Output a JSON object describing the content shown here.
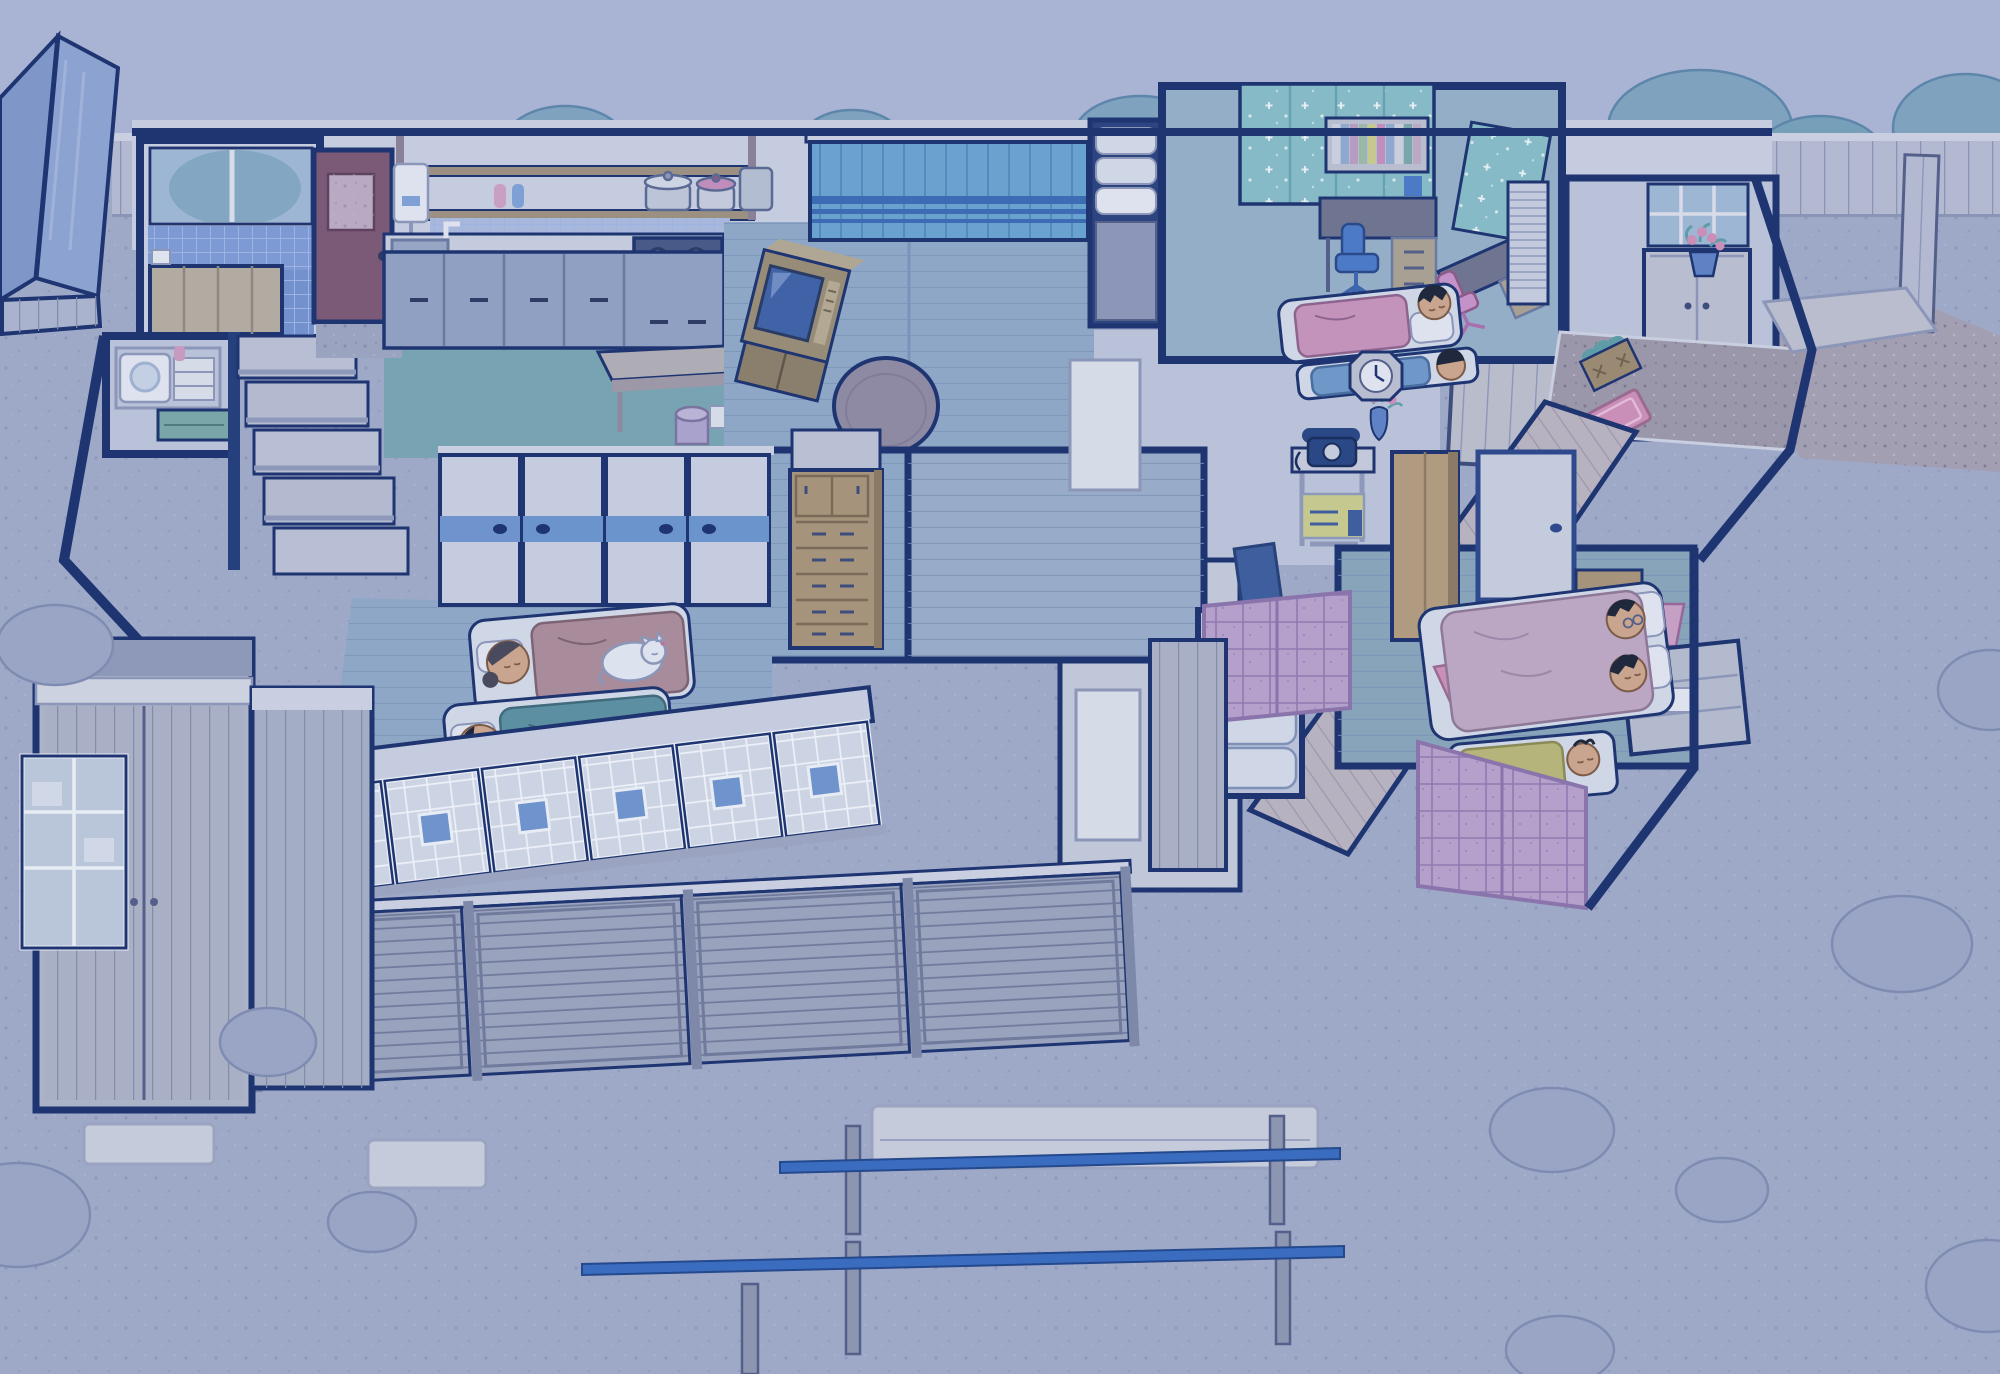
{
  "scene": {
    "title": "japanese-house-night-cutaway",
    "time_of_day": "night",
    "style": "isometric anime cutaway of a traditional Japanese family home, roof removed, blue night tint",
    "outdoor": [
      "wood plank fence",
      "blue-roof shed",
      "garden bushes",
      "gravel yard",
      "stone slabs",
      "two laundry drying poles",
      "stone path",
      "side fence"
    ],
    "rooms": [
      {
        "name": "bathroom",
        "objects": [
          "window with bush view",
          "blue tiled wall",
          "tiled floor",
          "covered wooden bathtub",
          "faucet"
        ]
      },
      {
        "name": "laundry-room",
        "objects": [
          "washing machine",
          "towel shelf",
          "bottle",
          "green cabinet"
        ]
      },
      {
        "name": "staircase",
        "objects": [
          "five descending steps"
        ]
      },
      {
        "name": "kitchen",
        "objects": [
          "maroon back door",
          "door mat",
          "wall shelf with pots",
          "spray bottles",
          "tankless water heater",
          "tile backsplash",
          "sink with faucet",
          "gas stove",
          "counter cabinets",
          "dining table",
          "canister bin"
        ]
      },
      {
        "name": "living-room",
        "objects": [
          "curtained window with stripes",
          "crt tv on wood cabinet",
          "round low table",
          "tatami floor",
          "futon closet with stacked futons"
        ]
      },
      {
        "name": "kids-room",
        "objects": [
          "patterned curtains",
          "study desk with bookshelf and books",
          "blue swivel chair",
          "second desk",
          "pink swivel chair",
          "cd rack",
          "futon with pink blanket",
          "futon with blue blanket"
        ],
        "occupants": [
          "sleeping boy",
          "sleeping girl"
        ]
      },
      {
        "name": "entryway",
        "objects": [
          "window",
          "shoe cabinet",
          "potted pink flowers",
          "speckled genkan floor",
          "pink mat",
          "vegetable box",
          "outside porch slab"
        ]
      },
      {
        "name": "hallway",
        "objects": [
          "wood plank floor",
          "telephone table",
          "navy rotary phone",
          "yellow box",
          "wall vase with flowers",
          "sliding door"
        ]
      },
      {
        "name": "family-room",
        "objects": [
          "chest of drawers",
          "upper cupboard",
          "blue cushion",
          "sliding fusuma doors with blue band"
        ]
      },
      {
        "name": "futon-closet",
        "objects": [
          "stacked folded futons"
        ]
      },
      {
        "name": "grandparents-room",
        "objects": [
          "futon with mauve blanket",
          "futon with teal blanket",
          "fusuma doors"
        ],
        "occupants": [
          "sleeping woman with hair bun",
          "white cat curled on blanket",
          "sleeping man"
        ]
      },
      {
        "name": "master-bedroom",
        "objects": [
          "futon",
          "pillows",
          "pink cloth",
          "wall clock",
          "wardrobe",
          "wood chest",
          "pink lamp",
          "low dresser",
          "white heater box",
          "lilac shoji windows"
        ],
        "occupants": [
          "two adults resting on futon",
          "sleeping toddler under yellow blanket"
        ]
      },
      {
        "name": "veranda",
        "objects": [
          "shoji screens with blue pane",
          "storm shutter panels",
          "plank door"
        ]
      },
      {
        "name": "storehouse",
        "objects": [
          "white rail",
          "plank sliding doors",
          "glass cabinet",
          "step slab"
        ]
      }
    ],
    "palette": {
      "sky": "#a9b4d4",
      "ground": "#9ea9c8",
      "fence": "#b2b9d1",
      "fenceRail": "#c9cfe0",
      "navy": "#1e3572",
      "navyMid": "#2e4a8c",
      "wallFace": "#c5cce0",
      "wallDim": "#b9c2d8",
      "tatami": "#8ea7c6",
      "tatamiTeal": "#87a4ba",
      "kidsFloor": "#93aec6",
      "woodFloor": "#b7b2c0",
      "kitchenFloor": "#77a3b2",
      "tileBlue": "#7e9ad4",
      "tileFloor": "#7391cc",
      "glass": "#9db6d4",
      "bathWood": "#b2aba1",
      "doorMaroon": "#7b5a78",
      "curtain": "#6aa2cf",
      "curtainStripe": "#3e6cb4",
      "curtainTeal": "#86bac6",
      "shojiBlue": "#6f93cc",
      "shojiPaper": "#ccd4e4",
      "amado": "#9aa3bd",
      "amadoFrame": "#6f7a9c",
      "planks": "#a9b0c6",
      "futon": "#cfd6e6",
      "pillow": "#dde2ee",
      "blanketPink": "#c493bb",
      "blanketMauve": "#a88c9c",
      "blanketTeal": "#5d8fa2",
      "blanketLime": "#b5b47a",
      "blanketBlue": "#6f97c8",
      "blanketCouple": "#bba6c4",
      "skin": "#c9a48e",
      "hair": "#20283e",
      "cat": "#dde3ee",
      "wood": "#a6937b",
      "woodDark": "#8a7a66",
      "tv": "#978c78",
      "screen": "#3f63a6",
      "chairBlue": "#4d7ac6",
      "chairPink": "#c292c8",
      "phone": "#2b4886",
      "lamp": "#c69fc4",
      "lilac": "#b5a0cb",
      "lilacFrame": "#8a74ac",
      "shedRoof": "#7e96c8",
      "shedRoof2": "#8ca3d2",
      "shedWall": "#aab3cd",
      "bush": "#7fa3bf",
      "bushEdge": "#5d86aa",
      "bushYard": "#9aa5c6",
      "bushYardEdge": "#7f8cb2",
      "pole": "#3a6cc0",
      "post": "#8d96b0",
      "slab": "#c6cbdb",
      "steel": "#c3cbdc",
      "stove": "#4a5a88",
      "cabinet": "#8fa0c2",
      "pathStone": "#a39fb3",
      "genkanFloor": "#9b97aa",
      "white": "#e2e7f1",
      "green": "#79a6a8",
      "yellowBox": "#c5c98f",
      "pink": "#c98fb8",
      "potBlue": "#5f82c4",
      "bookA": "#c8cede",
      "bookB": "#8fa8d0",
      "bookC": "#b79bc0",
      "bookD": "#9ab8a8"
    }
  }
}
